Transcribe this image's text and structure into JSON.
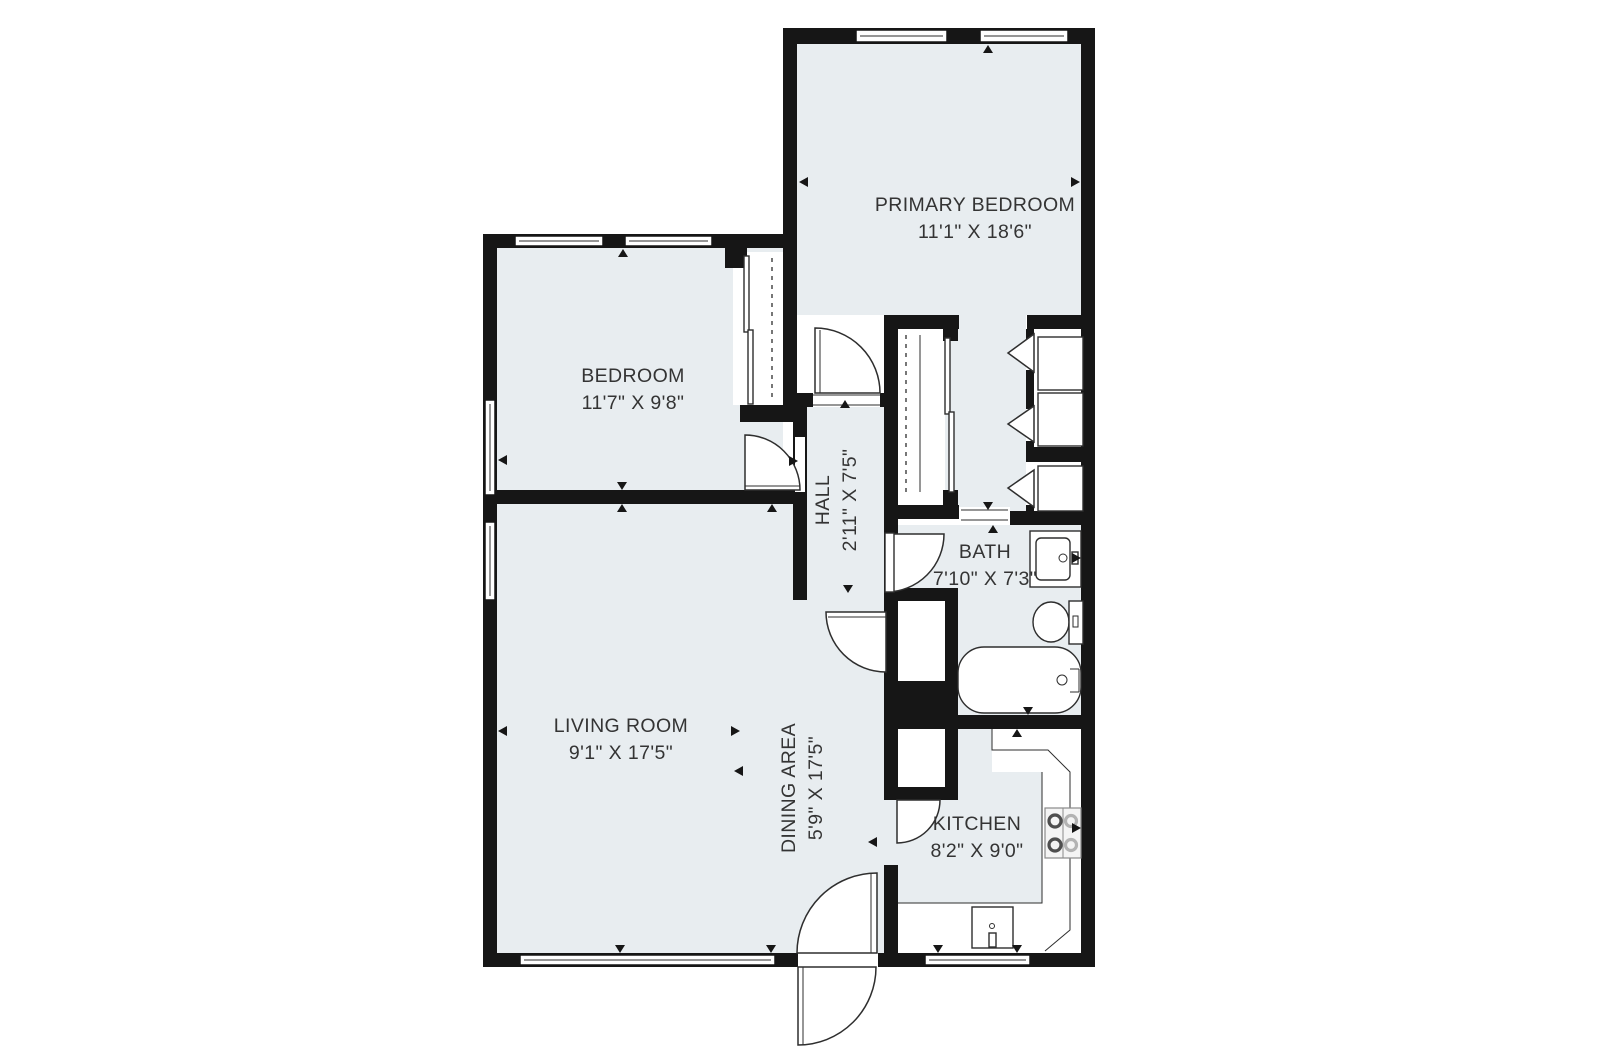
{
  "floorplan": {
    "rooms": [
      {
        "name": "PRIMARY BEDROOM",
        "dims": "11'1\" X 18'6\"",
        "label_orientation": "horizontal"
      },
      {
        "name": "BEDROOM",
        "dims": "11'7\" X 9'8\"",
        "label_orientation": "horizontal"
      },
      {
        "name": "HALL",
        "dims": "2'11\" X 7'5\"",
        "label_orientation": "vertical"
      },
      {
        "name": "BATH",
        "dims": "7'10\" X 7'3\"",
        "label_orientation": "horizontal"
      },
      {
        "name": "LIVING ROOM",
        "dims": "9'1\" X 17'5\"",
        "label_orientation": "horizontal"
      },
      {
        "name": "DINING AREA",
        "dims": "5'9\" X 17'5\"",
        "label_orientation": "vertical"
      },
      {
        "name": "KITCHEN",
        "dims": "8'2\" X 9'0\"",
        "label_orientation": "horizontal"
      }
    ],
    "fixtures": [
      "bathtub",
      "toilet",
      "vanity-sink",
      "kitchen-sink",
      "stove-cooktop",
      "bifold-closet-doors",
      "sliding-closet-doors",
      "swing-doors",
      "entry-double-swing-door",
      "windows",
      "kitchen-counter"
    ],
    "colors": {
      "room_fill": "#e8edf0",
      "wall": "#161616",
      "line": "#2e2e2e",
      "background": "#ffffff",
      "text": "#343434"
    }
  }
}
